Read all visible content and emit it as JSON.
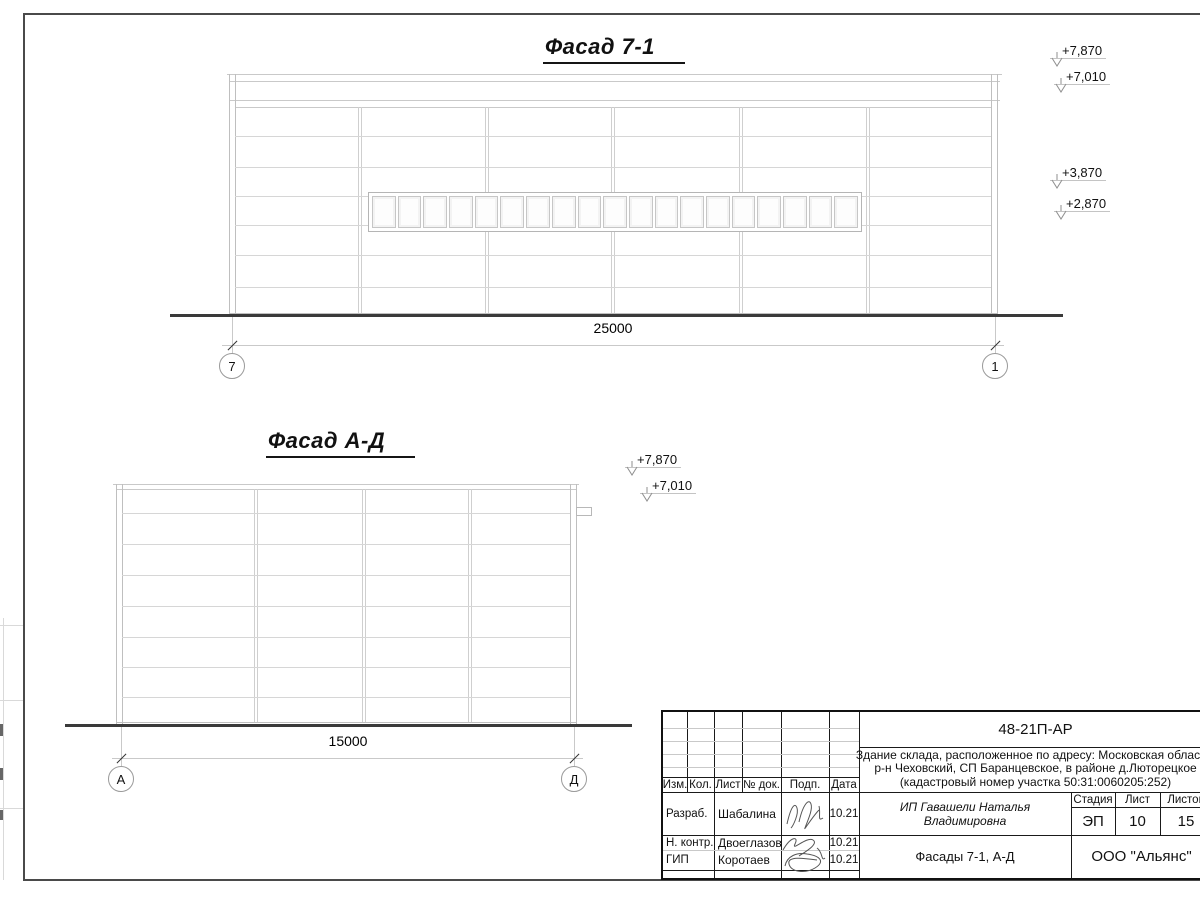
{
  "drawing": {
    "facade_7_1": {
      "title": "Фасад 7-1",
      "dimension": "25000",
      "grid_left": "7",
      "grid_right": "1",
      "levels": {
        "l1": "+7,870",
        "l2": "+7,010",
        "l3": "+3,870",
        "l4": "+2,870"
      },
      "window_panes": 19
    },
    "facade_a_d": {
      "title": "Фасад А-Д",
      "dimension": "15000",
      "grid_left": "А",
      "grid_right": "Д",
      "levels": {
        "l1": "+7,870",
        "l2": "+7,010"
      }
    }
  },
  "title_block": {
    "doc_number": "48-21П-АР",
    "description_line1": "Здание склада, расположенное по адресу: Московская область,",
    "description_line2": "р-н Чеховский, СП Баранцевское, в районе д.Люторецкое",
    "description_line3": "(кадастровый номер участка 50:31:0060205:252)",
    "col_izm": "Изм.",
    "col_kol": "Кол.",
    "col_list": "Лист",
    "col_doc": "№ док.",
    "col_podp": "Подп.",
    "col_data": "Дата",
    "row1_role": "Разраб.",
    "row1_name": "Шабалина",
    "row1_date": "10.21",
    "row2_role": "Н. контр.",
    "row2_name": "Двоеглазов",
    "row2_date": "10.21",
    "row3_role": "ГИП",
    "row3_name": "Коротаев",
    "row3_date": "10.21",
    "client": "ИП Гавашели Наталья Владимировна",
    "stage_label": "Стадия",
    "sheet_label": "Лист",
    "sheets_label": "Листов",
    "stage": "ЭП",
    "sheet": "10",
    "sheets": "15",
    "sheet_title": "Фасады 7-1, А-Д",
    "organization": "ООО \"Альянс\""
  }
}
